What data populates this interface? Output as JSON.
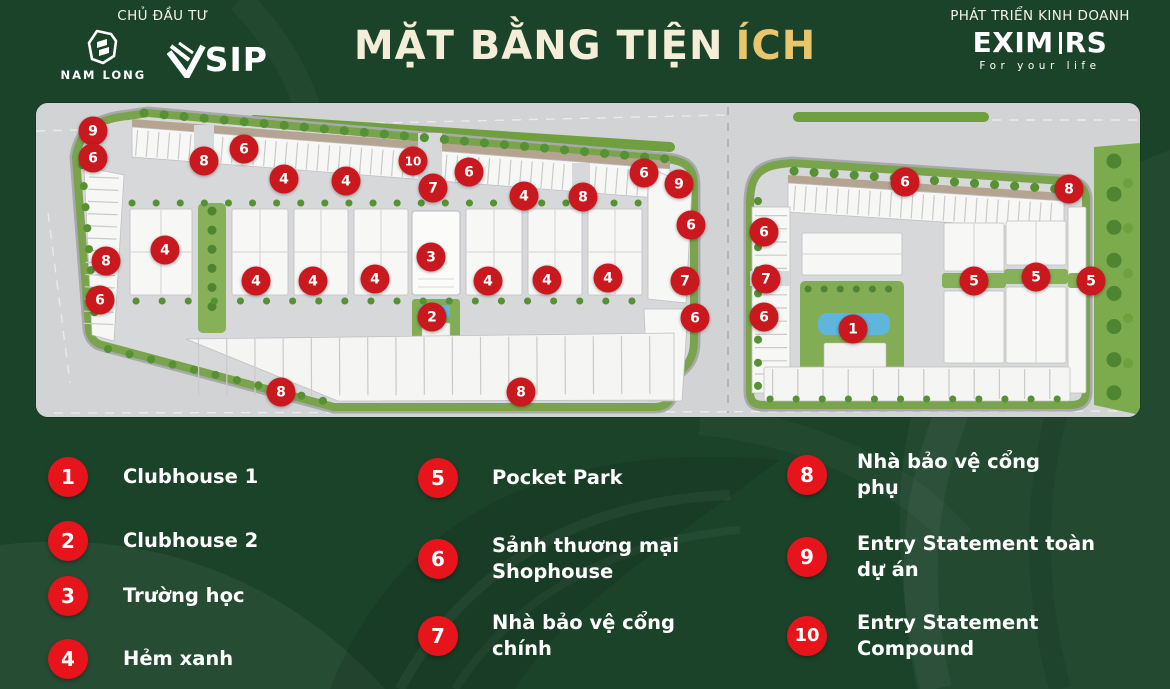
{
  "header": {
    "investor_label": "CHỦ ĐẦU TƯ",
    "developer_label": "PHÁT TRIỂN KINH DOANH",
    "title_main": "MẶT BẰNG TIỆN",
    "title_accent": "ÍCH",
    "nam_long_wordmark": "NAM LONG",
    "vsip_brand": "VSIP",
    "vsip_wordmark_tail": "SIP",
    "eximrs_left": "EXIM",
    "eximrs_right": "RS",
    "eximrs_tagline": "For your life"
  },
  "map": {
    "description": "Site master plan with numbered amenity markers",
    "markers": [
      {
        "n": "9",
        "x": 57,
        "y": 28
      },
      {
        "n": "6",
        "x": 57,
        "y": 55
      },
      {
        "n": "8",
        "x": 168,
        "y": 58
      },
      {
        "n": "6",
        "x": 208,
        "y": 46
      },
      {
        "n": "4",
        "x": 248,
        "y": 76
      },
      {
        "n": "4",
        "x": 310,
        "y": 78
      },
      {
        "n": "10",
        "x": 377,
        "y": 58
      },
      {
        "n": "7",
        "x": 397,
        "y": 85
      },
      {
        "n": "6",
        "x": 433,
        "y": 69
      },
      {
        "n": "4",
        "x": 488,
        "y": 93
      },
      {
        "n": "8",
        "x": 547,
        "y": 94
      },
      {
        "n": "6",
        "x": 608,
        "y": 70
      },
      {
        "n": "9",
        "x": 643,
        "y": 81
      },
      {
        "n": "6",
        "x": 655,
        "y": 122
      },
      {
        "n": "8",
        "x": 70,
        "y": 158
      },
      {
        "n": "6",
        "x": 64,
        "y": 197
      },
      {
        "n": "4",
        "x": 129,
        "y": 147
      },
      {
        "n": "4",
        "x": 220,
        "y": 178
      },
      {
        "n": "4",
        "x": 277,
        "y": 178
      },
      {
        "n": "4",
        "x": 339,
        "y": 176
      },
      {
        "n": "3",
        "x": 395,
        "y": 154
      },
      {
        "n": "2",
        "x": 396,
        "y": 214
      },
      {
        "n": "4",
        "x": 452,
        "y": 178
      },
      {
        "n": "4",
        "x": 511,
        "y": 177
      },
      {
        "n": "4",
        "x": 572,
        "y": 175
      },
      {
        "n": "7",
        "x": 649,
        "y": 178
      },
      {
        "n": "6",
        "x": 659,
        "y": 215
      },
      {
        "n": "8",
        "x": 245,
        "y": 289
      },
      {
        "n": "8",
        "x": 485,
        "y": 289
      },
      {
        "n": "6",
        "x": 869,
        "y": 79
      },
      {
        "n": "8",
        "x": 1033,
        "y": 86
      },
      {
        "n": "6",
        "x": 728,
        "y": 129
      },
      {
        "n": "7",
        "x": 730,
        "y": 176
      },
      {
        "n": "6",
        "x": 728,
        "y": 214
      },
      {
        "n": "1",
        "x": 817,
        "y": 226
      },
      {
        "n": "5",
        "x": 938,
        "y": 178
      },
      {
        "n": "5",
        "x": 1000,
        "y": 174
      },
      {
        "n": "5",
        "x": 1055,
        "y": 178
      }
    ]
  },
  "legend": {
    "columns": [
      {
        "left": 48,
        "gap": 35,
        "items": [
          {
            "n": "1",
            "top": 457,
            "lines": [
              "Clubhouse 1"
            ]
          },
          {
            "n": "2",
            "top": 521,
            "lines": [
              "Clubhouse 2"
            ]
          },
          {
            "n": "3",
            "top": 576,
            "lines": [
              "Trường học"
            ]
          },
          {
            "n": "4",
            "top": 639,
            "lines": [
              "Hẻm xanh"
            ]
          }
        ]
      },
      {
        "left": 418,
        "gap": 34,
        "items": [
          {
            "n": "5",
            "top": 458,
            "lines": [
              "Pocket Park"
            ]
          },
          {
            "n": "6",
            "top": 533,
            "lines": [
              "Sảnh thương mại",
              "Shophouse"
            ]
          },
          {
            "n": "7",
            "top": 610,
            "lines": [
              "Nhà bảo vệ cổng",
              "chính"
            ]
          }
        ]
      },
      {
        "left": 787,
        "gap": 30,
        "items": [
          {
            "n": "8",
            "top": 449,
            "lines": [
              "Nhà bảo vệ cổng",
              "phụ"
            ]
          },
          {
            "n": "9",
            "top": 531,
            "lines": [
              "Entry Statement toàn",
              "dự án"
            ]
          },
          {
            "n": "10",
            "top": 610,
            "lines": [
              "Entry Statement",
              "Compound"
            ]
          }
        ]
      }
    ]
  },
  "colors": {
    "background_green": "#1b432a",
    "title_cream": "#f4edd8",
    "title_gold": "#e9c56c",
    "legend_red": "#e8141c",
    "map_marker_red": "#c9181e",
    "map_grass_green": "#7aa54c",
    "map_pool_blue": "#5fb5da"
  }
}
